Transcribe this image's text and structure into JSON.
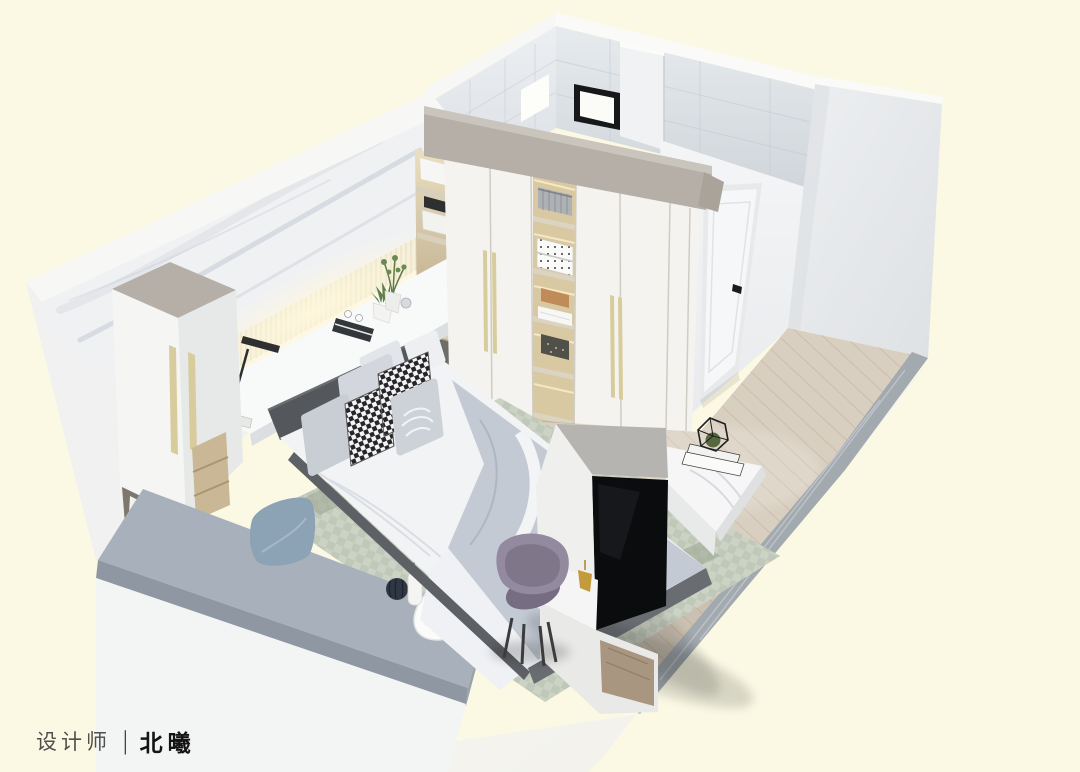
{
  "credit": {
    "role": "设计师",
    "divider": "|",
    "name": "北曦"
  },
  "colors": {
    "background": "#FBF9E4",
    "wall_white": "#F3F4F5",
    "left_wall_white": "#F0F1F0",
    "tile_wall": "#E3E7EB",
    "soffit": "#B5AFA7",
    "wardrobe": "#F4F3EF",
    "wardrobe_interior_wood": "#D9C9A3",
    "handle_gold": "#D9CC9C",
    "marble_base": "#F0F1F3",
    "marble_vein": "#BEC6D0",
    "slat_warm": "#F2EDDA",
    "desk_white": "#F8F9F9",
    "headboard": "#54575B",
    "bed_white": "#F2F3F5",
    "duvet_gray": "#C3CAD4",
    "bed_rail": "#696D72",
    "pillow_gray": "#D3D7DD",
    "checker_dark": "#26262A",
    "platform_cushion": "#A8B1BB",
    "platform_base": "#F3F4F4",
    "pillow_blue": "#8CA2B5",
    "rug": "#CCD3C5",
    "rug_check": "#A9B2A2",
    "wood_floor": "#D9CFC0",
    "wood_plank_line": "#C2B4A2",
    "stone_border": "#A2A9AF",
    "tv_screen": "#0B0C0E",
    "island_gray": "#B6B4B1",
    "island_white": "#EFEFED",
    "chair_purple": "#938AA0",
    "door_white": "#F6F7F8",
    "plant_green": "#5F7D49",
    "terrarium_frame": "#1F1F1F",
    "gold_decor": "#C39B3A",
    "credit_role_color": "#4F4F4D",
    "credit_name_color": "#141414"
  }
}
